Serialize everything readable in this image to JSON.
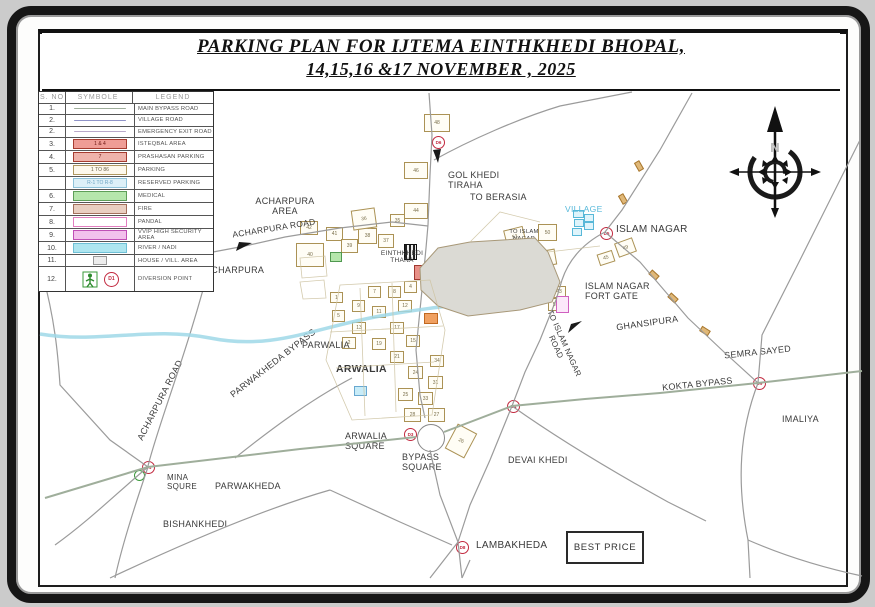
{
  "title": {
    "line1": "PARKING PLAN FOR IJTEMA EINTHKHEDI BHOPAL,",
    "line2": "14,15,16 &17 NOVEMBER ,  2025"
  },
  "legend": {
    "headers": [
      "S. NO",
      "SYMBOLE",
      "LEGEND"
    ],
    "rows": [
      {
        "no": "1.",
        "label": "MAIN BYPASS ROAD",
        "sym": "line",
        "color": "#9fae9b"
      },
      {
        "no": "2.",
        "label": "VILLAGE  ROAD",
        "sym": "line",
        "color": "#8f93c8"
      },
      {
        "no": "2.",
        "label": "EMERGENCY EXIT ROAD",
        "sym": "line",
        "color": "#b9a9c9"
      },
      {
        "no": "3.",
        "label": "ISTEQBAL AREA",
        "sym": "box",
        "text": "1 & 4",
        "bg": "#ef9d96",
        "bd": "#a63c30",
        "fg": "#6d1511"
      },
      {
        "no": "4.",
        "label": "PRASHASAN PARKING",
        "sym": "box",
        "text": "7",
        "bg": "#efb3ab",
        "bd": "#a63c30",
        "fg": "#6d1511"
      },
      {
        "no": "5.",
        "label": "PARKING",
        "sym": "box",
        "text": "1 TO 86",
        "bg": "#fdf8ec",
        "bd": "#b09860",
        "fg": "#6b6148"
      },
      {
        "no": "",
        "label": "RESERVED PARKING",
        "sym": "box",
        "text": "R-1 TO R-8",
        "bg": "#ddf0f8",
        "bd": "#8fc3da",
        "fg": "#6da4c2"
      },
      {
        "no": "6.",
        "label": "MEDICAL",
        "sym": "box",
        "text": "",
        "bg": "#b5e6ac",
        "bd": "#5d9e58",
        "fg": "#333"
      },
      {
        "no": "7.",
        "label": "FIRE",
        "sym": "box",
        "text": "",
        "bg": "#e9cfc1",
        "bd": "#a3705c",
        "fg": "#333"
      },
      {
        "no": "8.",
        "label": "PANDAL",
        "sym": "box",
        "text": "",
        "bg": "#ffffff",
        "bd": "#e27fc0",
        "fg": "#333"
      },
      {
        "no": "9.",
        "label": "VVIP HIGH SECURITY AREA",
        "sym": "box",
        "text": "",
        "bg": "#f2c0ec",
        "bd": "#c04fb6",
        "fg": "#333"
      },
      {
        "no": "10.",
        "label": "RIVER / NADI",
        "sym": "box",
        "text": "",
        "bg": "#aee6f0",
        "bd": "#6fc0d6",
        "fg": "#333"
      },
      {
        "no": "11.",
        "label": "HOUSE / VILL. AREA",
        "sym": "smallbox",
        "text": "",
        "bg": "#ededed",
        "bd": "#9a9a9a",
        "fg": "#999"
      },
      {
        "no": "12.",
        "label": "DIVERSION POINT",
        "sym": "diversion",
        "text": "D1"
      }
    ]
  },
  "compass": {
    "north_label": "N"
  },
  "map": {
    "best_price": "BEST PRICE",
    "labels": [
      {
        "t": "ACHARPURA\nAREA",
        "x": 240,
        "y": 196,
        "s": 9,
        "w": 90,
        "al": "center"
      },
      {
        "t": "ACHARPURA  ROAD",
        "x": 232,
        "y": 224,
        "s": 8.5,
        "rot": -9
      },
      {
        "t": "ACHARPURA",
        "x": 205,
        "y": 265,
        "s": 9
      },
      {
        "t": "GOL KHEDI\nTIRAHA",
        "x": 448,
        "y": 170,
        "s": 9
      },
      {
        "t": "TO BERASIA",
        "x": 470,
        "y": 192,
        "s": 9
      },
      {
        "t": "EINTHKHEDI\nTHANA",
        "x": 376,
        "y": 250,
        "s": 6.5,
        "w": 52,
        "al": "center"
      },
      {
        "t": "VILLAGE",
        "x": 565,
        "y": 205,
        "s": 8.5,
        "c": "#58b9da"
      },
      {
        "t": "ISLAM NAGAR",
        "x": 616,
        "y": 224,
        "s": 10
      },
      {
        "t": "ISLAM NAGAR\nFORT GATE",
        "x": 585,
        "y": 281,
        "s": 9
      },
      {
        "t": "GHANSIPURA",
        "x": 616,
        "y": 318,
        "s": 9,
        "rot": -8
      },
      {
        "t": "SEMRA SAYED",
        "x": 724,
        "y": 347,
        "s": 9,
        "rot": -6
      },
      {
        "t": "KOKTA BYPASS",
        "x": 662,
        "y": 379,
        "s": 9,
        "rot": -6
      },
      {
        "t": "IMALIYA",
        "x": 782,
        "y": 414,
        "s": 9
      },
      {
        "t": "IJTEMA\nGAH",
        "x": 462,
        "y": 262,
        "s": 9.5,
        "b": 1,
        "w": 70,
        "al": "center",
        "ls": 1.2
      },
      {
        "t": "TO ISLAM\nNAGAR",
        "x": 506,
        "y": 229,
        "s": 5.8,
        "w": 36,
        "al": "center"
      },
      {
        "t": "TO ISLAM NAGAR\nROAD",
        "x": 523,
        "y": 336,
        "s": 8,
        "rot": 66,
        "w": 74,
        "al": "center"
      },
      {
        "t": "PARWALIA",
        "x": 302,
        "y": 340,
        "s": 9
      },
      {
        "t": "ARWALIA",
        "x": 336,
        "y": 363,
        "s": 10.5,
        "b": 1
      },
      {
        "t": "PARWAKHEDA  BYPASS",
        "x": 212,
        "y": 358,
        "s": 9,
        "rot": -38,
        "w": 122,
        "al": "center"
      },
      {
        "t": "ACHARPURA  ROAD",
        "x": 108,
        "y": 395,
        "s": 9,
        "rot": -63,
        "w": 104,
        "al": "center"
      },
      {
        "t": "ARWALIA\nSQUARE",
        "x": 345,
        "y": 431,
        "s": 9
      },
      {
        "t": "BYPASS\nSQUARE",
        "x": 402,
        "y": 452,
        "s": 9
      },
      {
        "t": "MINA\nSQURE",
        "x": 167,
        "y": 473,
        "s": 8
      },
      {
        "t": "PARWAKHEDA",
        "x": 215,
        "y": 481,
        "s": 9
      },
      {
        "t": "BISHANKHEDI",
        "x": 163,
        "y": 519,
        "s": 9
      },
      {
        "t": "DEVAI  KHEDI",
        "x": 508,
        "y": 455,
        "s": 9
      },
      {
        "t": "LAMBAKHEDA",
        "x": 476,
        "y": 540,
        "s": 10
      }
    ],
    "parking_boxes": [
      {
        "n": "48",
        "x": 424,
        "y": 114,
        "w": 24,
        "h": 16
      },
      {
        "n": "46",
        "x": 404,
        "y": 162,
        "w": 22,
        "h": 15
      },
      {
        "n": "44",
        "x": 404,
        "y": 203,
        "w": 22,
        "h": 14
      },
      {
        "n": "42",
        "x": 300,
        "y": 221,
        "w": 16,
        "h": 12
      },
      {
        "n": "41",
        "x": 326,
        "y": 227,
        "w": 15,
        "h": 12
      },
      {
        "n": "40",
        "x": 296,
        "y": 243,
        "w": 26,
        "h": 22
      },
      {
        "n": "39",
        "x": 341,
        "y": 239,
        "w": 15,
        "h": 12
      },
      {
        "n": "38",
        "x": 358,
        "y": 228,
        "w": 17,
        "h": 14
      },
      {
        "n": "37",
        "x": 378,
        "y": 234,
        "w": 14,
        "h": 12
      },
      {
        "n": "36",
        "x": 352,
        "y": 209,
        "w": 22,
        "h": 18,
        "rot": -8
      },
      {
        "n": "35",
        "x": 390,
        "y": 214,
        "w": 13,
        "h": 11
      },
      {
        "n": "53",
        "x": 505,
        "y": 228,
        "w": 18,
        "h": 16,
        "rot": -14
      },
      {
        "n": "50",
        "x": 538,
        "y": 224,
        "w": 17,
        "h": 15
      },
      {
        "n": "51",
        "x": 538,
        "y": 250,
        "w": 16,
        "h": 14,
        "rot": -10
      },
      {
        "n": "52",
        "x": 536,
        "y": 266,
        "w": 14,
        "h": 12
      },
      {
        "n": "49",
        "x": 616,
        "y": 240,
        "w": 17,
        "h": 13,
        "rot": -20
      },
      {
        "n": "45",
        "x": 598,
        "y": 252,
        "w": 14,
        "h": 10,
        "rot": -18
      },
      {
        "n": "43",
        "x": 552,
        "y": 286,
        "w": 12,
        "h": 10
      },
      {
        "n": "55",
        "x": 548,
        "y": 298,
        "w": 13,
        "h": 11
      },
      {
        "n": "28",
        "x": 404,
        "y": 408,
        "w": 15,
        "h": 12
      },
      {
        "n": "27",
        "x": 428,
        "y": 408,
        "w": 15,
        "h": 12
      },
      {
        "n": "26",
        "x": 450,
        "y": 427,
        "w": 20,
        "h": 26,
        "rot": 28
      },
      {
        "n": "25",
        "x": 398,
        "y": 388,
        "w": 13,
        "h": 11
      },
      {
        "n": "33",
        "x": 418,
        "y": 392,
        "w": 13,
        "h": 11
      },
      {
        "n": "31",
        "x": 428,
        "y": 376,
        "w": 13,
        "h": 11
      },
      {
        "n": "24",
        "x": 408,
        "y": 366,
        "w": 13,
        "h": 11
      },
      {
        "n": "34",
        "x": 430,
        "y": 355,
        "w": 12,
        "h": 10
      },
      {
        "n": "21",
        "x": 390,
        "y": 351,
        "w": 12,
        "h": 10
      },
      {
        "n": "19",
        "x": 372,
        "y": 338,
        "w": 12,
        "h": 10
      },
      {
        "n": "17",
        "x": 390,
        "y": 322,
        "w": 12,
        "h": 10
      },
      {
        "n": "15",
        "x": 406,
        "y": 335,
        "w": 12,
        "h": 10
      },
      {
        "n": "13",
        "x": 352,
        "y": 322,
        "w": 12,
        "h": 10
      },
      {
        "n": "12",
        "x": 398,
        "y": 300,
        "w": 12,
        "h": 10
      },
      {
        "n": "11",
        "x": 372,
        "y": 306,
        "w": 12,
        "h": 10
      },
      {
        "n": "9",
        "x": 352,
        "y": 300,
        "w": 11,
        "h": 10
      },
      {
        "n": "8",
        "x": 388,
        "y": 286,
        "w": 11,
        "h": 10
      },
      {
        "n": "7",
        "x": 368,
        "y": 286,
        "w": 11,
        "h": 10
      },
      {
        "n": "5",
        "x": 332,
        "y": 310,
        "w": 11,
        "h": 10
      },
      {
        "n": "4",
        "x": 404,
        "y": 281,
        "w": 11,
        "h": 10
      },
      {
        "n": "2",
        "x": 342,
        "y": 337,
        "w": 12,
        "h": 10
      },
      {
        "n": "1",
        "x": 330,
        "y": 292,
        "w": 11,
        "h": 9
      }
    ],
    "colored_boxes": [
      {
        "x": 438,
        "y": 255,
        "w": 16,
        "h": 10,
        "bg": "#b5e6ac",
        "bd": "#509850"
      },
      {
        "x": 414,
        "y": 265,
        "w": 18,
        "h": 13,
        "bg": "#e89088",
        "bd": "#a03830"
      },
      {
        "x": 452,
        "y": 261,
        "w": 9,
        "h": 24,
        "bg": "#ffffff",
        "bd": "#222222",
        "bw": 2
      },
      {
        "x": 430,
        "y": 273,
        "w": 12,
        "h": 9,
        "bg": "#c8e8f8",
        "bd": "#6898c8"
      },
      {
        "x": 424,
        "y": 313,
        "w": 12,
        "h": 9,
        "bg": "#f0a060",
        "bd": "#c06820"
      },
      {
        "x": 556,
        "y": 296,
        "w": 11,
        "h": 15,
        "bg": "#fce8fa",
        "bd": "#d060c0"
      },
      {
        "x": 354,
        "y": 386,
        "w": 11,
        "h": 8,
        "bg": "#c8ecf8",
        "bd": "#68a8d0"
      },
      {
        "x": 330,
        "y": 252,
        "w": 10,
        "h": 8,
        "bg": "#b5e6ac",
        "bd": "#509850"
      },
      {
        "x": 573,
        "y": 210,
        "w": 9,
        "h": 6,
        "bg": "#dff4fb",
        "bd": "#58b8d8"
      },
      {
        "x": 584,
        "y": 214,
        "w": 8,
        "h": 6,
        "bg": "#dff4fb",
        "bd": "#58b8d8"
      },
      {
        "x": 574,
        "y": 219,
        "w": 8,
        "h": 6,
        "bg": "#dff4fb",
        "bd": "#58b8d8"
      },
      {
        "x": 584,
        "y": 222,
        "w": 8,
        "h": 6,
        "bg": "#dff4fb",
        "bd": "#58b8d8"
      },
      {
        "x": 572,
        "y": 228,
        "w": 8,
        "h": 6,
        "bg": "#dff4fb",
        "bd": "#58b8d8"
      },
      {
        "x": 404,
        "y": 244,
        "w": 11,
        "h": 14,
        "bg": "#2c2c2c",
        "bd": "#111111",
        "striped": true
      },
      {
        "x": 649,
        "y": 272,
        "w": 8,
        "h": 4,
        "bg": "#e0b878",
        "bd": "#a87830",
        "rot": 42
      },
      {
        "x": 668,
        "y": 295,
        "w": 8,
        "h": 4,
        "bg": "#e0b878",
        "bd": "#a87830",
        "rot": 42
      },
      {
        "x": 700,
        "y": 328,
        "w": 8,
        "h": 4,
        "bg": "#e0b878",
        "bd": "#a87830",
        "rot": 32
      },
      {
        "x": 634,
        "y": 163,
        "w": 8,
        "h": 4,
        "bg": "#e0b878",
        "bd": "#a87830",
        "rot": 60
      },
      {
        "x": 618,
        "y": 196,
        "w": 8,
        "h": 4,
        "bg": "#e0b878",
        "bd": "#a87830",
        "rot": 60
      }
    ],
    "diversion_points": [
      {
        "label": "D6",
        "x": 432,
        "y": 136
      },
      {
        "label": "D5",
        "x": 600,
        "y": 227
      },
      {
        "label": "D4",
        "x": 507,
        "y": 400
      },
      {
        "label": "D3",
        "x": 404,
        "y": 428
      },
      {
        "label": "D1",
        "x": 142,
        "y": 461
      },
      {
        "label": "D8",
        "x": 456,
        "y": 541
      },
      {
        "label": "D9",
        "x": 753,
        "y": 377
      }
    ],
    "circles": [
      {
        "x": 417,
        "y": 424,
        "d": 26,
        "bd": "#888888",
        "bw": 1.5
      },
      {
        "x": 134,
        "y": 470,
        "d": 9,
        "bd": "#3a9a3a",
        "bw": 1.5
      }
    ]
  }
}
